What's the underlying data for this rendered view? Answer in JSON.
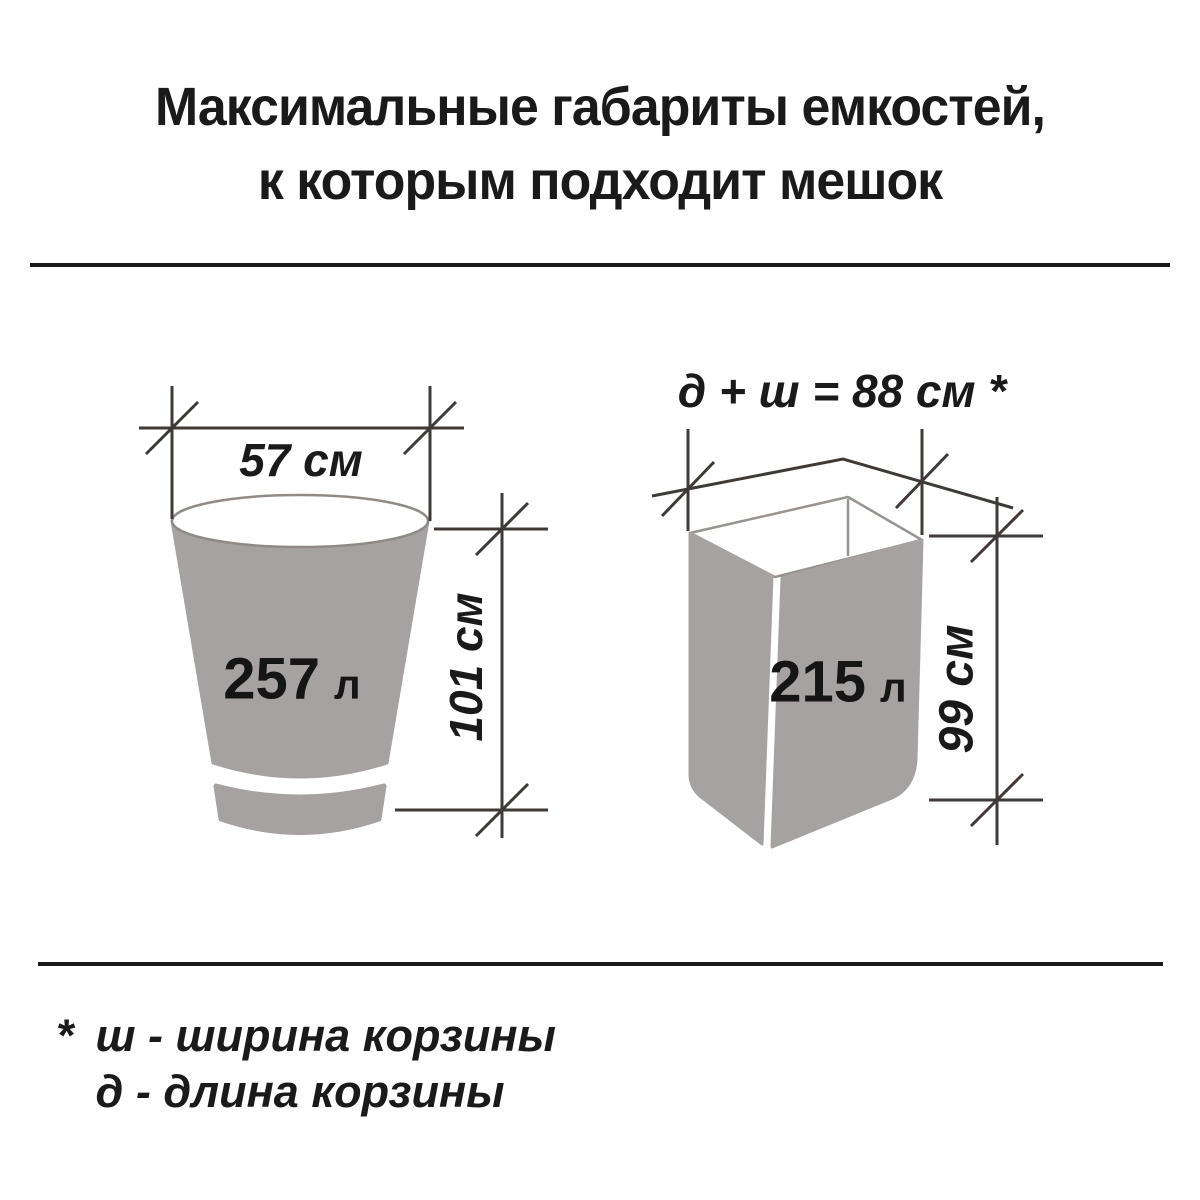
{
  "title": {
    "line1": "Максимальные габариты емкостей,",
    "line2": "к которым подходит мешок"
  },
  "bucket": {
    "volume_value": "257",
    "volume_unit": "л",
    "width_label": "57 см",
    "height_label": "101 см"
  },
  "bin": {
    "volume_value": "215",
    "volume_unit": "л",
    "top_label": "д + ш = 88 см *",
    "height_label": "99 см"
  },
  "footnote": {
    "marker": "*",
    "line1": "ш - ширина корзины",
    "line2": "д - длина корзины"
  },
  "colors": {
    "shape_gray": "#a7a2a2",
    "dimension_line": "#3f3a37",
    "outline": "#8f8a86",
    "divider": "#1a1a1a",
    "text": "#1a1a1a"
  }
}
